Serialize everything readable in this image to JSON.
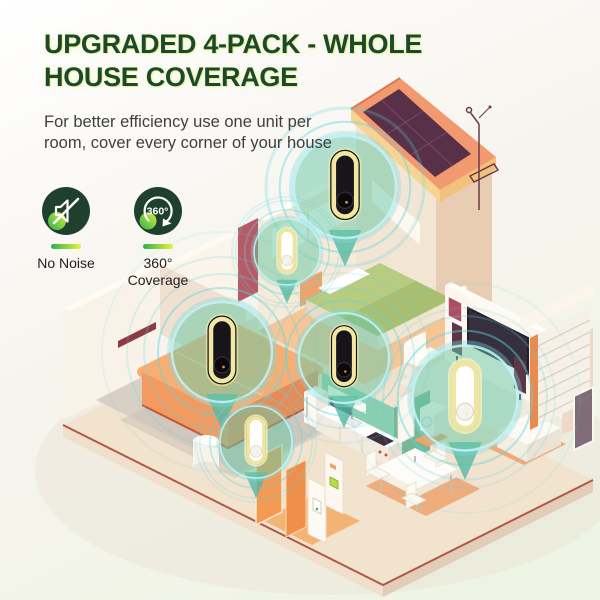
{
  "header": {
    "title_lines": [
      "UPGRADED 4-PACK - WHOLE",
      "HOUSE COVERAGE"
    ],
    "subtitle_lines": [
      "For better efficiency use one unit per",
      "room, cover every corner of your house"
    ]
  },
  "features": [
    {
      "icon": "no-noise-icon",
      "label_lines": [
        "No Noise"
      ]
    },
    {
      "icon": "360-coverage-icon",
      "icon_badge": "360°",
      "label_lines": [
        "360°",
        "Coverage"
      ]
    }
  ],
  "theme": {
    "title_color": "#1c4a28",
    "title_glow": "#d8ea5e",
    "subtitle_color": "#3f3f3f",
    "label_color": "#1f1f1f",
    "icon_bg": "#20402f",
    "accent_green": "#2fb14c",
    "accent_yellow": "#e9f23c",
    "ripple_teal": "#58d4de",
    "balloon_mint": "#66c7a6",
    "device_ring": "#f2e7a3",
    "device_black": "#17151a",
    "device_white": "#ffffff"
  }
}
